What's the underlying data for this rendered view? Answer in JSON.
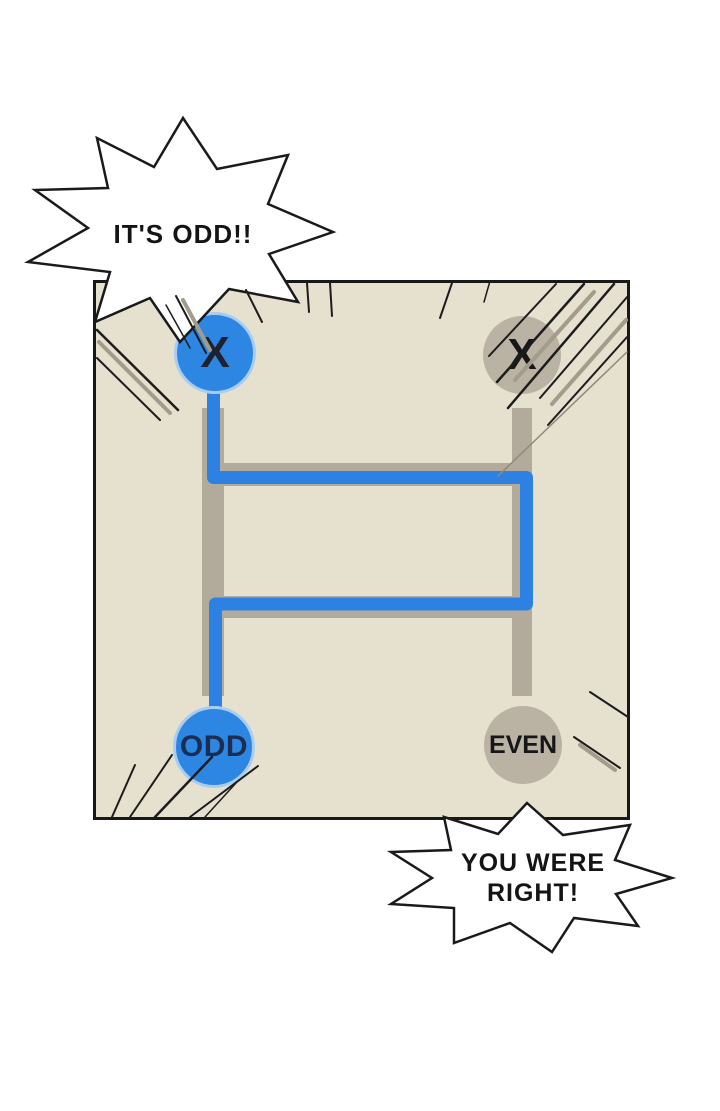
{
  "page": {
    "kind": "webtoon-comic-panel",
    "background": "#ffffff"
  },
  "bubbles": {
    "top": "IT'S ODD!!",
    "bottom": "YOU WERE RIGHT!"
  },
  "ladder_game": {
    "type": "amidakuji-ladder",
    "columns": 2,
    "rungs": 2,
    "start_labels": [
      "X",
      "X"
    ],
    "end_labels": [
      "ODD",
      "EVEN"
    ],
    "traced_start": "left X",
    "traced_result": "ODD"
  },
  "nodes": {
    "top_left": {
      "label": "X",
      "state": "selected-blue"
    },
    "top_right": {
      "label": "X",
      "state": "gray"
    },
    "bottom_left": {
      "label": "ODD",
      "state": "selected-blue"
    },
    "bottom_right": {
      "label": "EVEN",
      "state": "gray"
    }
  },
  "colors": {
    "highlight_blue": "#2e86e3",
    "path_blue": "#2d81e2",
    "blue_ring": "#a9cdf2",
    "panel_beige": "#e6e0cf",
    "ladder_gray": "#b2ab9b",
    "node_gray": "#bab3a4",
    "navy_text": "#1b2d52",
    "ink": "#1a1a1a"
  }
}
